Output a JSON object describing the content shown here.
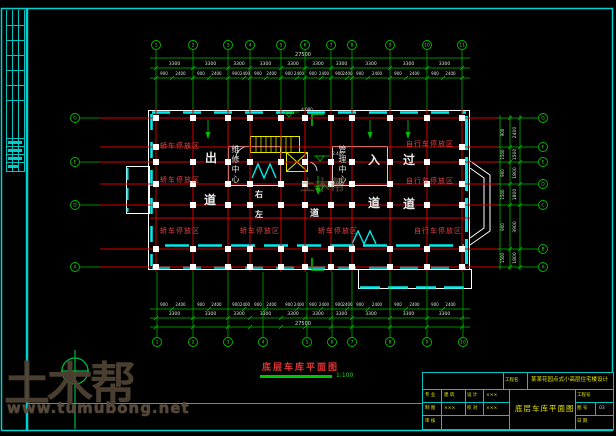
{
  "watermark": {
    "brand": "土木帮",
    "site": "www.tumubong.net"
  },
  "drawing": {
    "title": "底层车库平面图",
    "scale": "1:100",
    "labels": {
      "car": "轿车停放区",
      "bike": "自行车停放区",
      "exit": "出",
      "enter": "入",
      "pass": "过",
      "lane": "道",
      "left": "左",
      "right": "右",
      "core_left": "维修中心",
      "core_right": "管理中心"
    },
    "spots": [
      "4.080",
      "2.400",
      "0.060"
    ]
  },
  "grid": {
    "top": [
      "1",
      "2",
      "3",
      "4",
      "5",
      "6",
      "7",
      "8",
      "9",
      "10",
      "11"
    ],
    "bottom": [
      "1",
      "2",
      "3",
      "4",
      "5",
      "6",
      "7",
      "8",
      "9",
      "10"
    ],
    "left": [
      "G",
      "E",
      "D",
      "A"
    ],
    "right": [
      "G",
      "F",
      "E",
      "D",
      "C",
      "B",
      "A"
    ]
  },
  "dims": {
    "top_total": "27500",
    "bottom_total": "27500",
    "axis_bay": "3300",
    "detail_pair": [
      "900",
      "2400"
    ],
    "right_bays": [
      "2400",
      "1500",
      "1800",
      "1800",
      "3900",
      "1800"
    ],
    "right_details": [
      "900",
      "1500"
    ]
  },
  "title_block": {
    "project_label": "工程名",
    "project_name": "某某花园点式小高层住宅楼设计",
    "drawing_name": "底层车库平面图",
    "rows": [
      {
        "l1": "专 业",
        "v1": "建 筑",
        "l2": "设 计",
        "v2": "×××"
      },
      {
        "l1": "制 图",
        "v1": "×××",
        "l2": "校 对",
        "v2": "×××"
      },
      {
        "l1": "审 核",
        "v1": ""
      }
    ],
    "right_rows": [
      {
        "label": "工程号",
        "value": ""
      },
      {
        "label": "图 号",
        "value": "03"
      },
      {
        "label": "日 期",
        "value": ""
      }
    ]
  }
}
